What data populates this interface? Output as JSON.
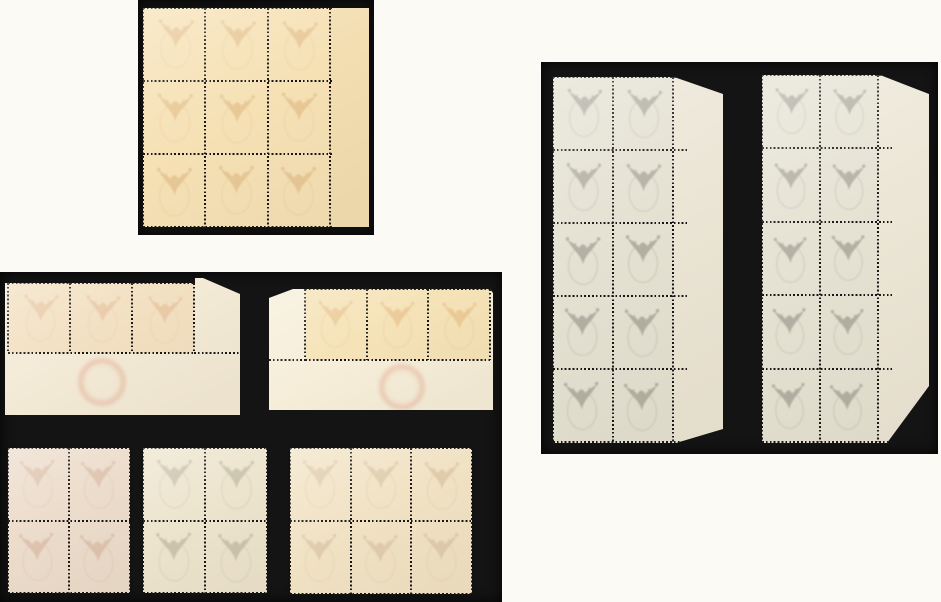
{
  "scene": {
    "background_color": "#fbfaf5",
    "mount_color": "#141414",
    "perforation_color": "#151515",
    "motif": "ox-head-offset",
    "subject": "mint stamp blocks shown from gum side on black mount cards"
  },
  "panels": [
    {
      "name": "mount-top-left",
      "x": 138,
      "y": 0,
      "w": 236,
      "h": 235,
      "pieces": [
        {
          "name": "block-of-nine-with-right-selvage",
          "x": 5,
          "y": 8,
          "w": 226,
          "h": 219,
          "paper": "#f3deb1",
          "stamps": {
            "x": 0,
            "y": 0,
            "cols": 3,
            "rows": 3,
            "cw": 62.33,
            "ch": 73,
            "color": "#f6e1b5",
            "offset_color": "#c68e52",
            "offset_opacity": 0.3
          },
          "overhang": 4
        }
      ]
    },
    {
      "name": "mount-bottom-left",
      "x": 0,
      "y": 272,
      "w": 502,
      "h": 330,
      "pieces": [
        {
          "name": "corner-strip-of-three-with-bottom-selvage-left",
          "x": 5,
          "y": 6,
          "w": 235,
          "h": 137,
          "paper": "#f3ead6",
          "clip": [
            [
              0,
              5
            ],
            [
              190,
              5
            ],
            [
              190,
              0
            ],
            [
              198,
              0
            ],
            [
              235,
              16
            ],
            [
              235,
              137
            ],
            [
              0,
              137
            ]
          ],
          "stamps": {
            "x": 3,
            "y": 5,
            "cols": 3,
            "rows": 1,
            "cw": 62,
            "ch": 70,
            "color": "#f2dfc0",
            "offset_color": "#cf8f60",
            "offset_opacity": 0.28
          },
          "extra_perfs": [
            {
              "dir": "h",
              "x": 189,
              "y": 75,
              "len": 46
            }
          ],
          "cachet": {
            "x": 95,
            "y": 102,
            "r": 21,
            "color": "#dd8a70"
          }
        },
        {
          "name": "corner-strip-of-three-with-bottom-selvage-right",
          "x": 269,
          "y": 13,
          "w": 224,
          "h": 125,
          "paper": "#f6eed9",
          "clip": [
            [
              0,
              13
            ],
            [
              24,
              4
            ],
            [
              221,
              4
            ],
            [
              224,
              8
            ],
            [
              224,
              125
            ],
            [
              0,
              125
            ]
          ],
          "stamps": {
            "x": 36,
            "y": 4,
            "cols": 3,
            "rows": 1,
            "cw": 61.67,
            "ch": 71,
            "color": "#f5e2b6",
            "offset_color": "#dd9c5e",
            "offset_opacity": 0.34
          },
          "extra_perfs": [
            {
              "dir": "h",
              "x": 0,
              "y": 75,
              "len": 36
            }
          ],
          "cachet": {
            "x": 131,
            "y": 100,
            "r": 20,
            "color": "#dd8a70"
          }
        },
        {
          "name": "block-of-four-rose",
          "x": 8,
          "y": 176,
          "w": 122,
          "h": 145,
          "paper": "#ecdccb",
          "stamps": {
            "x": 0,
            "y": 0,
            "cols": 2,
            "rows": 2,
            "cw": 61,
            "ch": 72.5,
            "color": "#ecdccb",
            "offset_color": "#bd8a6d",
            "offset_opacity": 0.3
          }
        },
        {
          "name": "block-of-four-cream",
          "x": 143,
          "y": 176,
          "w": 124,
          "h": 145,
          "paper": "#ede4cd",
          "stamps": {
            "x": 0,
            "y": 0,
            "cols": 2,
            "rows": 2,
            "cw": 62,
            "ch": 72.5,
            "color": "#ede4cd",
            "offset_color": "#8b8871",
            "offset_opacity": 0.34
          }
        },
        {
          "name": "block-of-six",
          "x": 290,
          "y": 176,
          "w": 182,
          "h": 146,
          "paper": "#f1e2c4",
          "stamps": {
            "x": 0,
            "y": 0,
            "cols": 3,
            "rows": 2,
            "cw": 60.67,
            "ch": 73,
            "color": "#f1e2c4",
            "offset_color": "#b3946f",
            "offset_opacity": 0.28
          }
        }
      ]
    },
    {
      "name": "mount-right",
      "x": 541,
      "y": 62,
      "w": 397,
      "h": 392,
      "pieces": [
        {
          "name": "block-of-ten-with-right-selvage-left",
          "x": 12,
          "y": 15,
          "w": 170,
          "h": 366,
          "paper": "#ebe5d5",
          "clip": [
            [
              0,
              0
            ],
            [
              121,
              0
            ],
            [
              170,
              17
            ],
            [
              170,
              352
            ],
            [
              123,
              366
            ],
            [
              0,
              366
            ]
          ],
          "stamps": {
            "x": 0,
            "y": 0,
            "cols": 2,
            "rows": 5,
            "cw": 60,
            "ch": 73,
            "color": "#e4e1d2",
            "offset_color": "#66645a",
            "offset_opacity": 0.4
          },
          "overhang": 14
        },
        {
          "name": "block-of-ten-with-right-selvage-right",
          "x": 221,
          "y": 13,
          "w": 167,
          "h": 368,
          "paper": "#ece6d6",
          "clip": [
            [
              0,
              0
            ],
            [
              118,
              0
            ],
            [
              167,
              19
            ],
            [
              167,
              311
            ],
            [
              125,
              368
            ],
            [
              0,
              368
            ]
          ],
          "stamps": {
            "x": 0,
            "y": 0,
            "cols": 2,
            "rows": 5,
            "cw": 58,
            "ch": 73.4,
            "color": "#e5e2d3",
            "offset_color": "#66645a",
            "offset_opacity": 0.4
          },
          "overhang": 14
        }
      ]
    }
  ]
}
